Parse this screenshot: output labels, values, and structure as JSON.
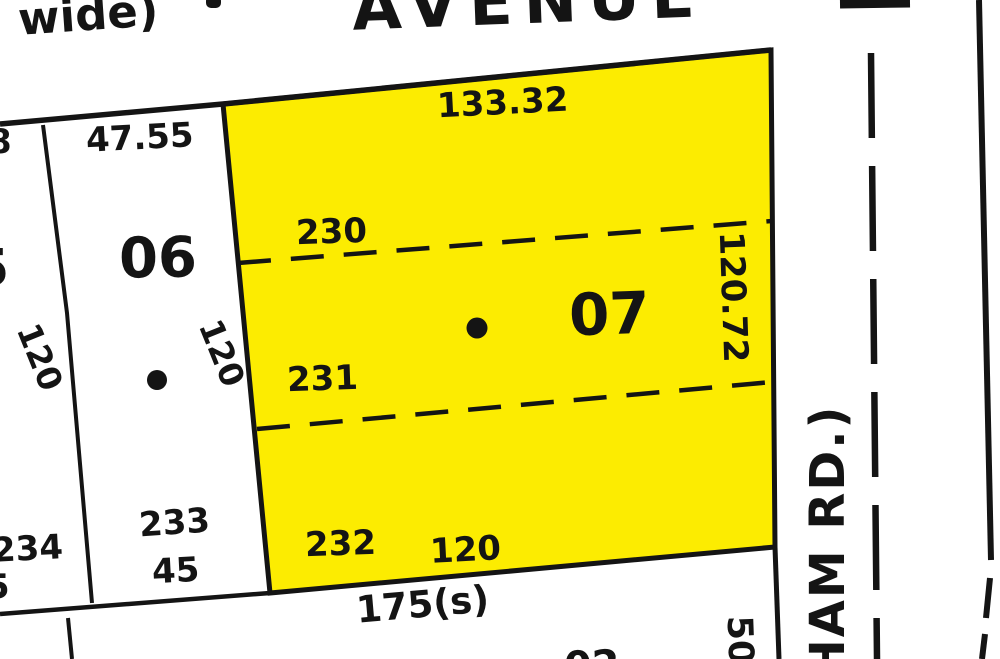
{
  "colors": {
    "highlight_yellow": "#fcec01",
    "line_black": "#141414",
    "background": "#ffffff"
  },
  "top_street": {
    "name_partial": "AVENUE",
    "note_partial": "wide)"
  },
  "side_street": {
    "name_partial": "HAM RD.)"
  },
  "highlighted_block": {
    "number": "07",
    "lot_numbers": [
      "230",
      "231",
      "232"
    ],
    "frontage_top": "133.32",
    "depth_right": "120.72",
    "width_bottom": "120"
  },
  "adjacent_block": {
    "number": "06",
    "frontage_top": "47.55",
    "depth_left": "120",
    "depth_right": "120",
    "lot_number": "233",
    "lot_width": "45"
  },
  "left_strip": {
    "lot_number": "234",
    "fragment_top": "8",
    "fragment_middle": "5",
    "fragment_bottom": "5"
  },
  "bottom_road": {
    "dimension": "175(s)",
    "fragment_rotated": "50",
    "fragment_lot": "02"
  }
}
